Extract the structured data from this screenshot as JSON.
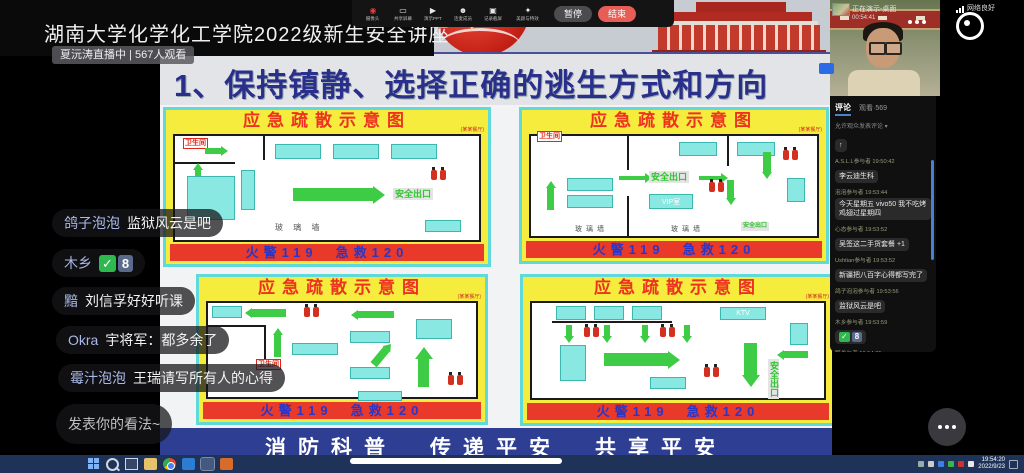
{
  "stream": {
    "title": "湖南大学化学化工学院2022级新生安全讲座",
    "status": "夏沅涛直播中 | 567人观看"
  },
  "toolbar": {
    "items": [
      {
        "label": "摄像头"
      },
      {
        "label": "共享屏幕"
      },
      {
        "label": "演示PPT"
      },
      {
        "label": "连麦成员"
      },
      {
        "label": "记录截屏"
      },
      {
        "label": "美颜与特效"
      }
    ],
    "pause_label": "暂停",
    "end_label": "结束"
  },
  "slide": {
    "title": "1、保持镇静、选择正确的逃生方式和方向",
    "diagram_title": "应急疏散示意图",
    "diagram_subtitle": "(某某餐厅)",
    "hotline": "火警119　急救120",
    "footer": "消防科普　传递平安　共享平安",
    "labels": {
      "exit": "安全出口",
      "toilet": "卫生间",
      "glass_spaced": "玻 璃 墙",
      "glass": "玻璃墙",
      "vip": "VIP室",
      "ktv": "KTV"
    }
  },
  "presenter": {
    "sharing": "正在演示-桌面",
    "duration": "00:54:41",
    "network": "网络良好"
  },
  "comments": {
    "tab_comments": "评论",
    "tab_watch": "观看·569",
    "filter": "允许观众发表评论 ▾",
    "reaction": "↑",
    "messages": [
      {
        "meta": "A.S.L.L参与者 19:50:42",
        "text": "李云迪生科"
      },
      {
        "meta": "泡泡参与者 19:53:44",
        "text": "今天星期五 vivo50 我不吃烤鸡翅过星期四"
      },
      {
        "meta": "心态参与者 19:53:52",
        "text": "吴签这二手货套餐 +1"
      },
      {
        "meta": "Ushtian参与者 19:53:52",
        "text": "新疆把八百字心得都写完了"
      },
      {
        "meta": "鸽子泡泡参与者 19:53:56",
        "text": "监狱风云是吧"
      },
      {
        "meta": "木乡参与者 19:53:59",
        "text": "✅8"
      },
      {
        "meta": "黯参与者 19:54:05",
        "text": "刘信孚好好听课"
      }
    ]
  },
  "emoji": {
    "check": "✓",
    "num": "8"
  },
  "danmaku": {
    "messages": [
      {
        "name": "鸽子泡泡",
        "text": "监狱风云是吧"
      },
      {
        "name": "木乡",
        "text": "✅8"
      },
      {
        "name": "黯",
        "text": "刘信孚好好听课"
      },
      {
        "name": "Okra",
        "text": "宇将军：都多余了"
      },
      {
        "name": "霉汁泡泡",
        "text": "王瑞请写所有人的心得"
      }
    ],
    "input_placeholder": "发表你的看法~"
  },
  "taskbar": {
    "time": "19:54:20",
    "date": "2022/9/23"
  }
}
